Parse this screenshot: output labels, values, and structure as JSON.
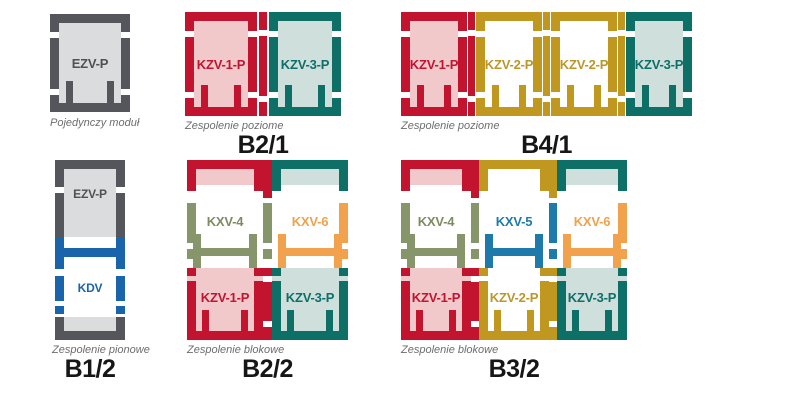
{
  "diagram": {
    "background": "#ffffff",
    "palette": {
      "gray": {
        "frame": "#54565c",
        "fill": "#dbdcde",
        "text": "#4e5257"
      },
      "red": {
        "frame": "#c2132f",
        "fill": "#f2c9cb",
        "text": "#c2132f"
      },
      "teal": {
        "frame": "#0e6f66",
        "fill": "#cfdfdb",
        "text": "#0d6f6a"
      },
      "gold": {
        "frame": "#c0971f",
        "fill": "#ffffff",
        "text": "#bc9629"
      },
      "blue": {
        "frame": "#1a64ab",
        "fill": "#ffffff",
        "text": "#1a64ab"
      },
      "olive": {
        "frame": "#87966a",
        "fill": "#ffffff",
        "text": "#7c8b60"
      },
      "steel": {
        "frame": "#1e7aaa",
        "fill": "#ffffff",
        "text": "#1e7aaa"
      },
      "orange": {
        "frame": "#f2a24d",
        "fill": "#ffffff",
        "text": "#f0a14d"
      }
    },
    "groups": [
      {
        "id": "single",
        "kind": "single",
        "caption": "Pojedynczy moduł",
        "title": "",
        "modules": [
          {
            "label": "EZV-P",
            "scheme": "gray"
          }
        ]
      },
      {
        "id": "b2-1",
        "kind": "row",
        "caption": "Zespolenie poziome",
        "title": "B2/1",
        "modules": [
          {
            "label": "KZV-1-P",
            "scheme": "red"
          },
          {
            "label": "KZV-3-P",
            "scheme": "teal"
          }
        ],
        "connectors": [
          "red"
        ]
      },
      {
        "id": "b4-1",
        "kind": "row",
        "caption": "Zespolenie poziome",
        "title": "B4/1",
        "modules": [
          {
            "label": "KZV-1-P",
            "scheme": "red"
          },
          {
            "label": "KZV-2-P",
            "scheme": "gold"
          },
          {
            "label": "KZV-2-P",
            "scheme": "gold"
          },
          {
            "label": "KZV-3-P",
            "scheme": "teal"
          }
        ],
        "connectors": [
          "red",
          "gold",
          "gold"
        ]
      },
      {
        "id": "b1-2",
        "kind": "vertical",
        "caption": "Zespolenie pionowe",
        "title": "B1/2",
        "modules": [
          {
            "label": "EZV-P",
            "scheme": "gray"
          },
          {
            "label": "KDV",
            "scheme": "blue"
          }
        ]
      },
      {
        "id": "b2-2",
        "kind": "block",
        "caption": "Zespolenie blokowe",
        "title": "B2/2",
        "columns": [
          {
            "top": {
              "label": "KXV-4",
              "scheme": "olive"
            },
            "bottom": {
              "label": "KZV-1-P",
              "scheme": "red"
            }
          },
          {
            "top": {
              "label": "KXV-6",
              "scheme": "orange"
            },
            "bottom": {
              "label": "KZV-3-P",
              "scheme": "teal"
            }
          }
        ]
      },
      {
        "id": "b3-2",
        "kind": "block",
        "caption": "Zespolenie blokowe",
        "title": "B3/2",
        "columns": [
          {
            "top": {
              "label": "KXV-4",
              "scheme": "olive"
            },
            "bottom": {
              "label": "KZV-1-P",
              "scheme": "red"
            }
          },
          {
            "top": {
              "label": "KXV-5",
              "scheme": "steel"
            },
            "bottom": {
              "label": "KZV-2-P",
              "scheme": "gold"
            }
          },
          {
            "top": {
              "label": "KXV-6",
              "scheme": "orange"
            },
            "bottom": {
              "label": "KZV-3-P",
              "scheme": "teal"
            }
          }
        ]
      }
    ]
  }
}
